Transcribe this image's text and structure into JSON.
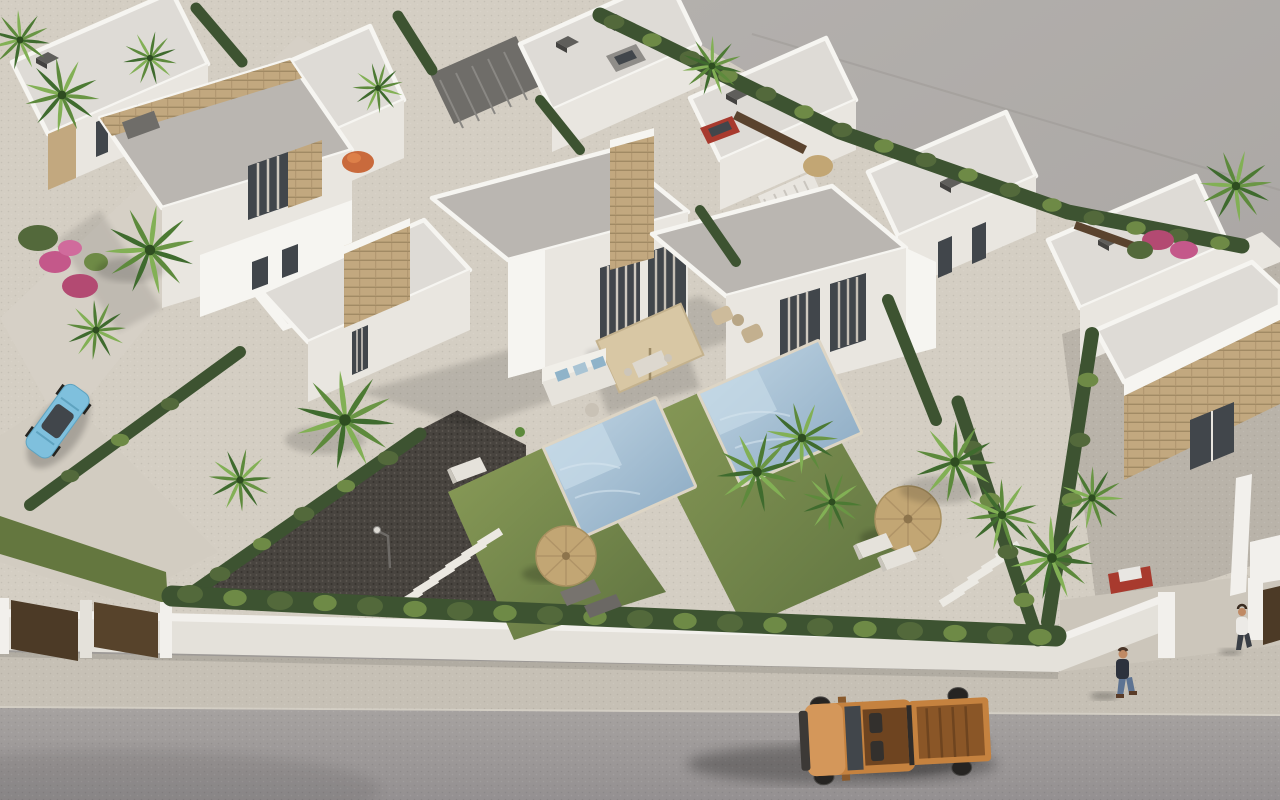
{
  "scene": {
    "type": "3d-architectural-render",
    "view": "aerial three-quarter view, sunlight from upper right, shadows cast to lower left",
    "subject": "new-build residential development of modern white villas with private pools and gardens",
    "background": "plain grey unbuilt ground occupies the upper-right of the frame",
    "foreground": "street with sidewalk and white boundary wall runs along the bottom"
  },
  "colors": {
    "bg-upper": "#b6b3b0",
    "bg-lower": "#a6a2a0",
    "road": "#a39f9d",
    "road-dark": "#96928f",
    "sidewalk": "#c6c0b5",
    "court": "#ccc6bb",
    "pavement": "#d4cec3",
    "wall-white": "#f2f0ec",
    "wall-face": "#e4e1da",
    "gravel": "#48443f",
    "gravel-light": "#b9b3a9",
    "grass": "#7e9151",
    "grass-dark": "#64773f",
    "hedge-dark": "#3d5331",
    "hedge-mid": "#53693b",
    "hedge-light": "#6e8a46",
    "palm-dark": "#3f6b2e",
    "palm-mid": "#5d8a3c",
    "palm-light": "#82b055",
    "roof": "#bab6b1",
    "roof-light": "#dedbd6",
    "white-bright": "#f6f5f1",
    "white-face": "#e9e6e0",
    "white-shade": "#d4d1ca",
    "glass": "#41464b",
    "curtain": "#cfc9bf",
    "stone": "#c2a87f",
    "stone-dark": "#a18a64",
    "pool": "#93b2ca",
    "pool-light": "#c6dae7",
    "coping": "#ddd5c5",
    "parasol": "#d8c7a4",
    "straw": "#c2a674",
    "wood": "#4c3a26",
    "truck-body": "#c5823f",
    "truck-hood": "#d4975a",
    "truck-bed": "#8a5627",
    "car-blue": "#7fc0dd",
    "car-red": "#a83a2e",
    "skin": "#c08a64",
    "denim": "#5d7392",
    "jacket": "#2d323d",
    "shirt": "#eceae6"
  },
  "inventory": {
    "buildings": "rows of flat-roofed white villas with sand-stone cladding accents and dark rooftop chimney caps",
    "pools": 2,
    "straw-parasols": 2,
    "beige-terrace-parasol": 1,
    "orange-garden-parasol": 1,
    "vehicles": [
      "orange pickup truck on road",
      "light blue car parked left",
      "red car behind hedge right",
      "grey car top street",
      "red car top street"
    ],
    "people": [
      "pedestrian in dark jacket on sidewalk",
      "person in white shirt at right gate"
    ],
    "landscaping": [
      "palm trees",
      "cypress hedgerows",
      "lawns",
      "bougainvillea beds",
      "stepping stones",
      "sun loungers",
      "gravel driveway",
      "street lamp"
    ]
  }
}
